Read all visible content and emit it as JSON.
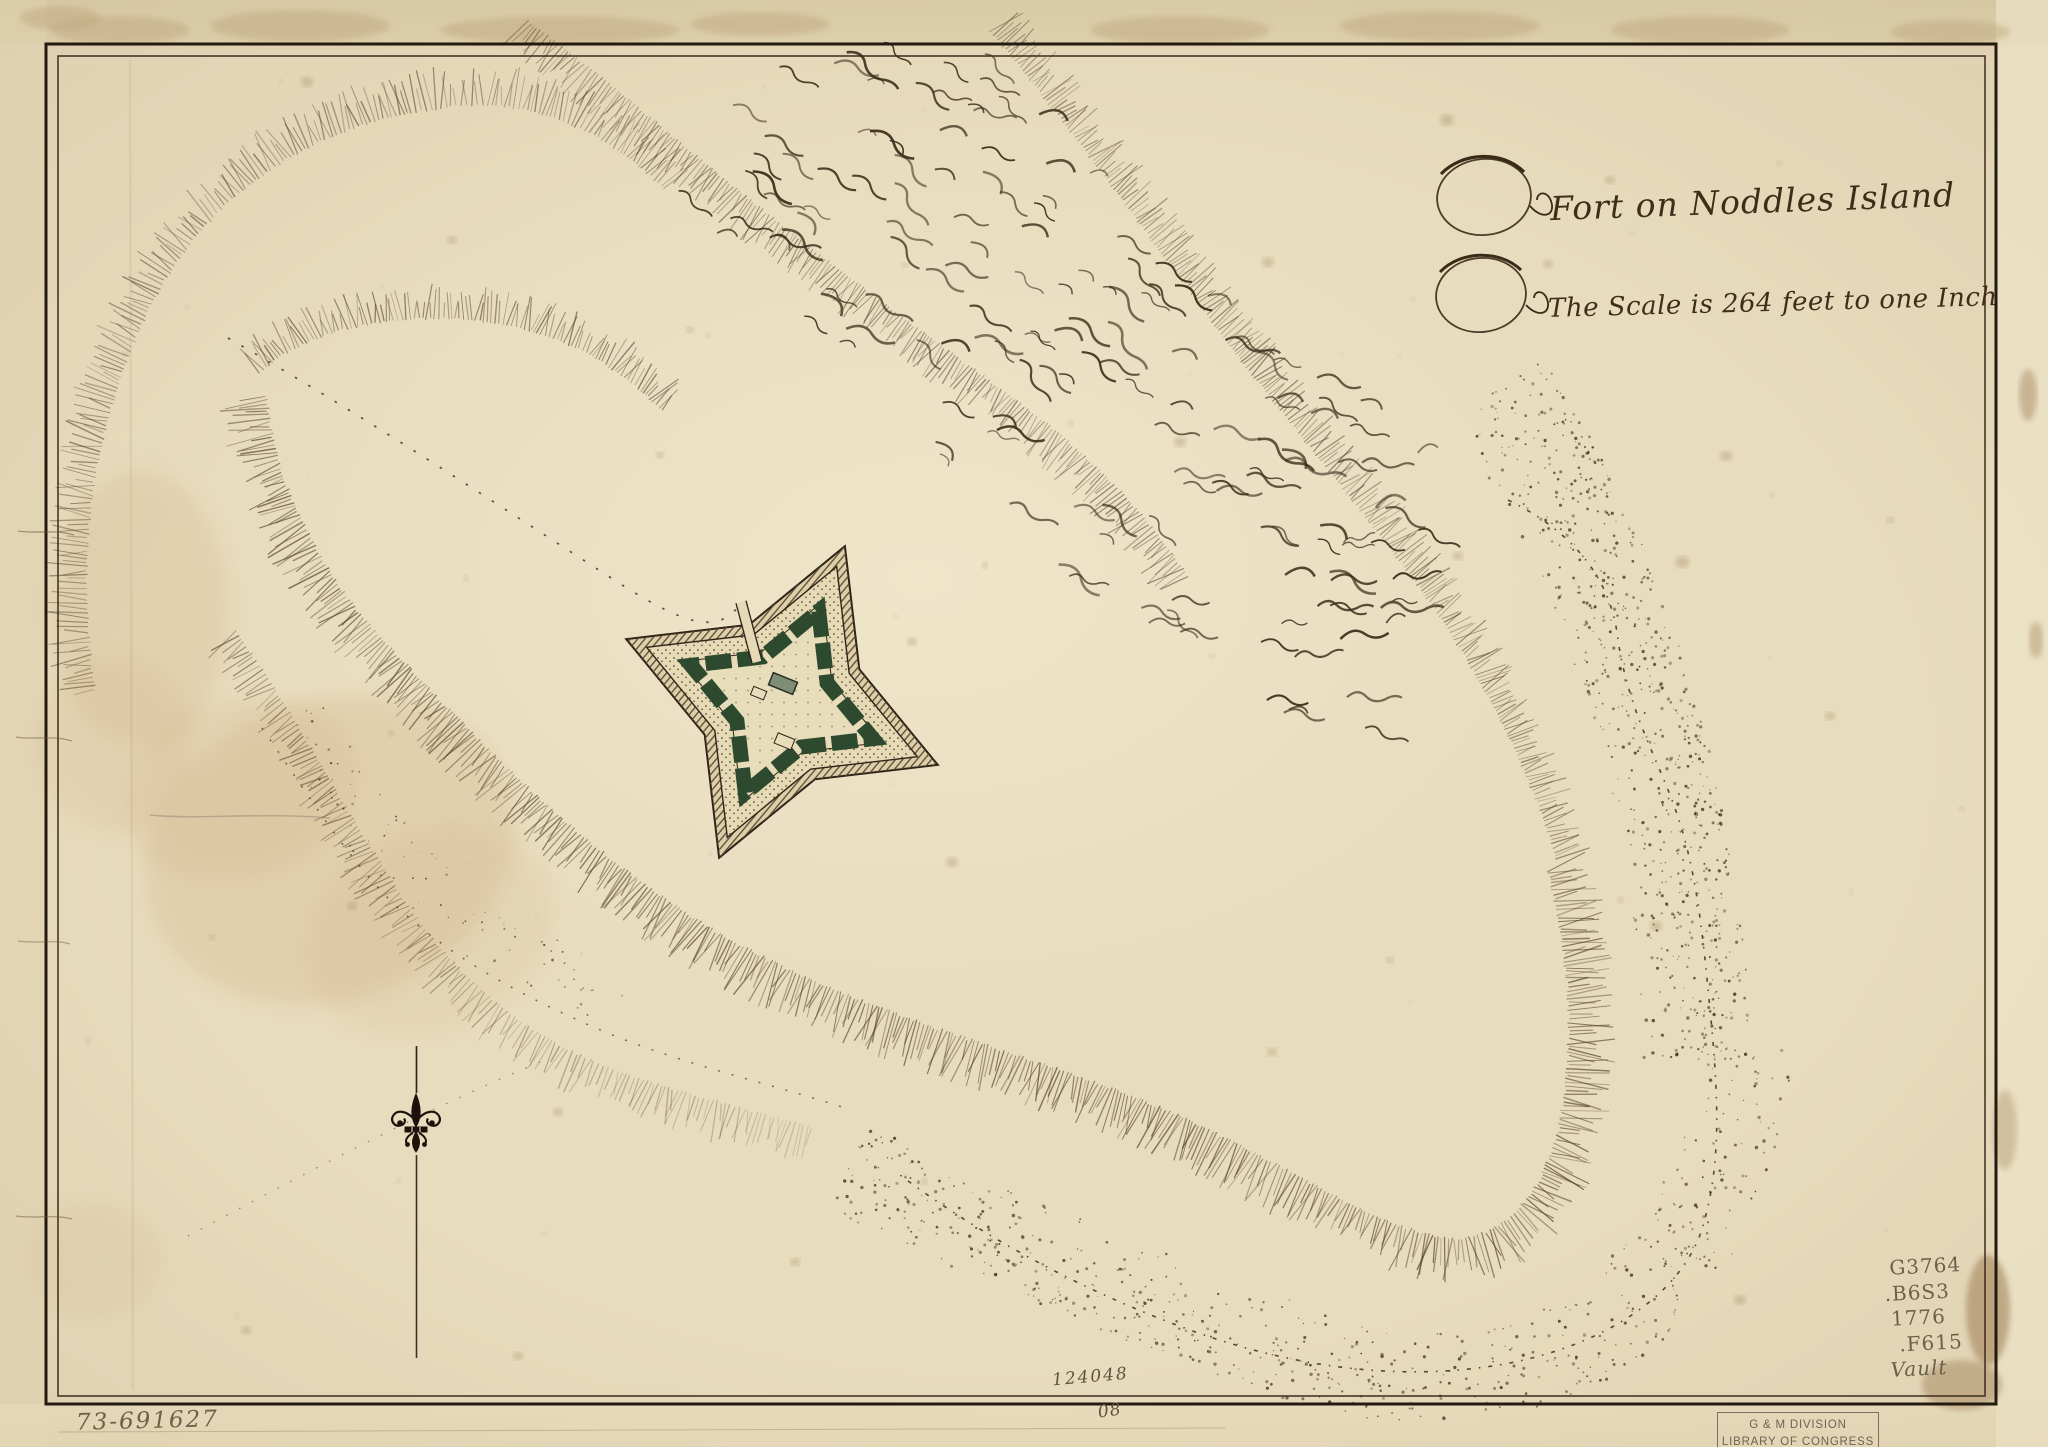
{
  "map": {
    "title": "Fort on Noddles Island",
    "scale_note": "The Scale is 264 feet to one Inch"
  },
  "annotations": {
    "negative_number": "73-691627",
    "accession_number": "124048",
    "plate_number": "08",
    "call_number": [
      "G3764",
      ".B6S3",
      "1776",
      ".F615",
      "Vault"
    ]
  },
  "stamp": {
    "division": "G & M DIVISION",
    "institution": "LIBRARY OF CONGRESS"
  },
  "icons": {
    "north_marker": "fleur-de-lis-icon"
  },
  "palette": {
    "paper": "#e8dcbe",
    "paper_light": "#e9debf",
    "ink": "#2e2318",
    "hachure": "#4f3f28",
    "fort_green": "#2d4a2f",
    "fort_band": "#dccfa9",
    "pencil": "#6d5f48",
    "stamp_ink": "#6f6455",
    "stain": "#b99a6b"
  }
}
